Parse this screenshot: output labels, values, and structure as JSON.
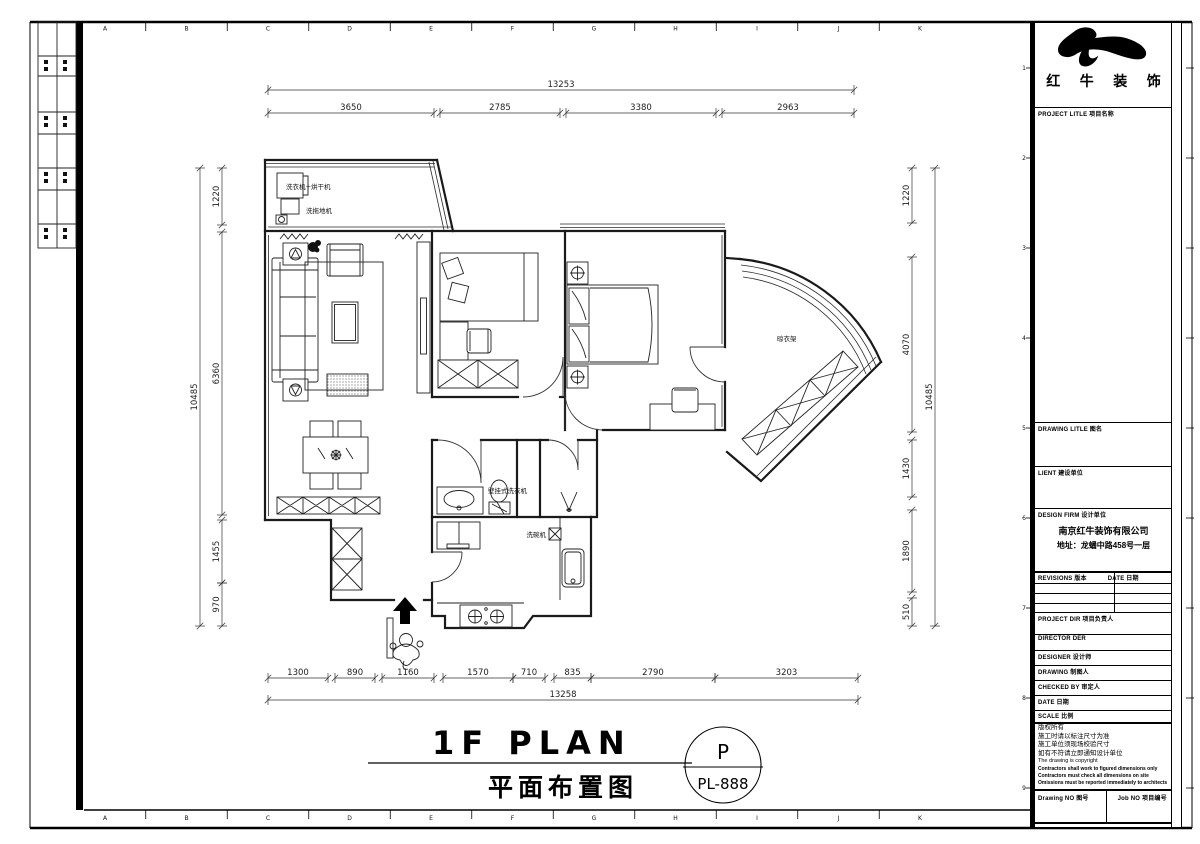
{
  "border": {
    "top_letters": [
      "A",
      "B",
      "C",
      "D",
      "E",
      "F",
      "G",
      "H",
      "I",
      "J",
      "K"
    ],
    "bottom_letters": [
      "A",
      "B",
      "C",
      "D",
      "E",
      "F",
      "G",
      "H",
      "I",
      "J",
      "K"
    ],
    "side_numbers": [
      "1",
      "2",
      "3",
      "4",
      "5",
      "6",
      "7",
      "8",
      "9"
    ]
  },
  "title_block": {
    "company_name": "红 牛 装 饰",
    "project_title_label": "PROJECT LITLE 项目名称",
    "drawing_title_label": "DRAWING LITLE 图名",
    "client_label": "LIENT 建设单位",
    "design_firm_label": "DESIGN FIRM 设计单位",
    "design_firm_name": "南京红牛装饰有限公司",
    "design_firm_address": "地址：龙蟠中路458号一层",
    "revisions_label": "REVISIONS 版本",
    "revisions_date_label": "DATE 日期",
    "project_dir_label": "PROJECT DIR 项目负责人",
    "director_label": "DIRECTOR DER",
    "designer_label": "DESIGNER 设计师",
    "drawing_label": "DRAWING 制图人",
    "checked_by_label": "CHECKED BY 审定人",
    "date_label": "DATE 日期",
    "scale_label": "SCALE 比例",
    "copyright_lines": [
      "版权所有",
      "施工时请以标注尺寸为准",
      "施工单位须现场校验尺寸",
      "如有不符请立即通知设计单位",
      "The drawing is copyright",
      "Contractors shall work to figured dimensions only",
      "Contractors must check all dimensions on site",
      "Omissions must be reported immediately to architects"
    ],
    "drawing_no_label": "Drawing NO 图号",
    "job_no_label": "Job NO 项目编号"
  },
  "plan": {
    "labels": {
      "washer_dryer": "洗衣机+烘干机",
      "floor_washer": "洗拖地机",
      "drying_rack": "晾衣架",
      "wall_washer": "壁挂式洗衣机",
      "dishwasher": "洗碗机"
    },
    "dims": {
      "top_total": "13253",
      "top": [
        "3650",
        "2785",
        "3380",
        "2963"
      ],
      "bottom": [
        "1300",
        "890",
        "1160",
        "1570",
        "710",
        "835",
        "2790",
        "3203"
      ],
      "bottom_total": "13258",
      "left": [
        "1220",
        "6360",
        "1455",
        "970"
      ],
      "left_total": "10485",
      "right": [
        "1220",
        "4070",
        "1430",
        "1890",
        "510"
      ],
      "right_total": "10485"
    }
  },
  "footer": {
    "title_en": "1F PLAN",
    "title_cn": "平面布置图",
    "sheet_letter": "P",
    "sheet_no": "PL-888"
  }
}
